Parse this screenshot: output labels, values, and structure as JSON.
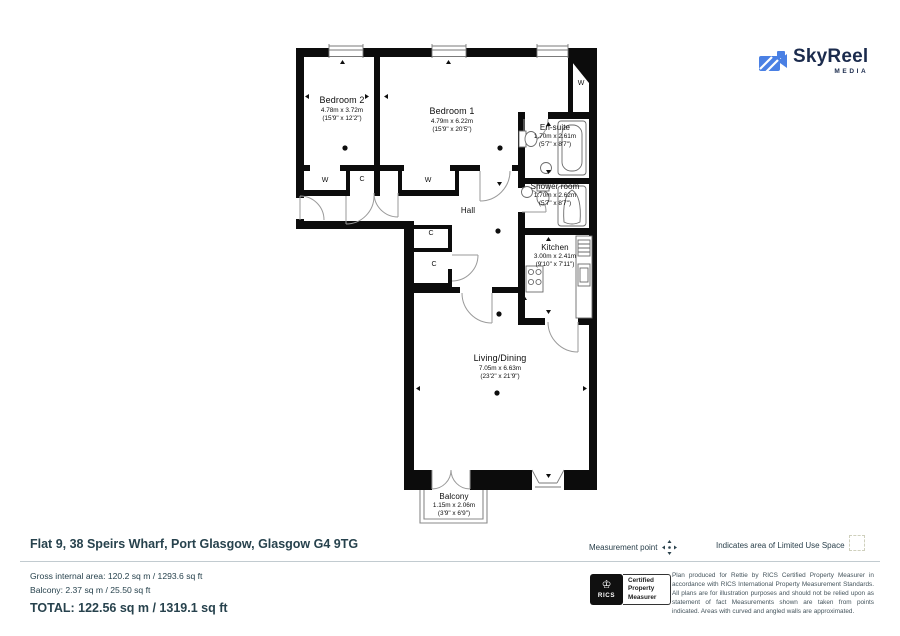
{
  "colors": {
    "logo_blue": "#4a80e4",
    "footer_text": "#27424d",
    "wall": "#0c0c0c"
  },
  "brand": {
    "name": "SkyReel",
    "sub": "MEDIA"
  },
  "plan": {
    "labels": {
      "wardrobe": "W",
      "closet": "C"
    },
    "rooms": [
      {
        "name": "Bedroom 2",
        "metric": "4.78m x 3.72m",
        "imperial": "(15'9\" x 12'2\")"
      },
      {
        "name": "Bedroom 1",
        "metric": "4.79m x 6.22m",
        "imperial": "(15'9\" x 20'5\")"
      },
      {
        "name": "En-suite",
        "metric": "1.70m x 2.61m",
        "imperial": "(5'7\" x 8'7\")"
      },
      {
        "name": "Shower room",
        "metric": "1.70m x 2.62m",
        "imperial": "(5'7\" x 8'7\")"
      },
      {
        "name": "Kitchen",
        "metric": "3.00m x 2.41m",
        "imperial": "(9'10\" x 7'11\")"
      },
      {
        "name": "Hall"
      },
      {
        "name": "Living/Dining",
        "metric": "7.05m x 6.63m",
        "imperial": "(23'2\" x 21'9\")"
      },
      {
        "name": "Balcony",
        "metric": "1.15m x 2.06m",
        "imperial": "(3'9\" x 6'9\")"
      }
    ]
  },
  "footer": {
    "address": "Flat 9, 38 Speirs Wharf, Port Glasgow, Glasgow G4 9TG",
    "measurement_point": "Measurement point",
    "limited_use": "Indicates area of  Limited Use Space",
    "gross_area": "Gross internal area: 120.2 sq m / 1293.6 sq ft",
    "balcony_area": "Balcony: 2.37 sq m / 25.50 sq ft",
    "total_area": "TOTAL: 122.56 sq m / 1319.1 sq ft",
    "rics_label": "RICS",
    "certification": {
      "line1": "Certified",
      "line2": "Property",
      "line3": "Measurer"
    },
    "disclaimer": "Plan produced for Rettie by RICS Certified Property Measurer in accordance with RICS International Property  Measurement Standards.  All plans are for illustration purposes and should not be relied upon as statement of fact Measurements shown are taken from points indicated. Areas with curved and angled walls are approximated."
  }
}
